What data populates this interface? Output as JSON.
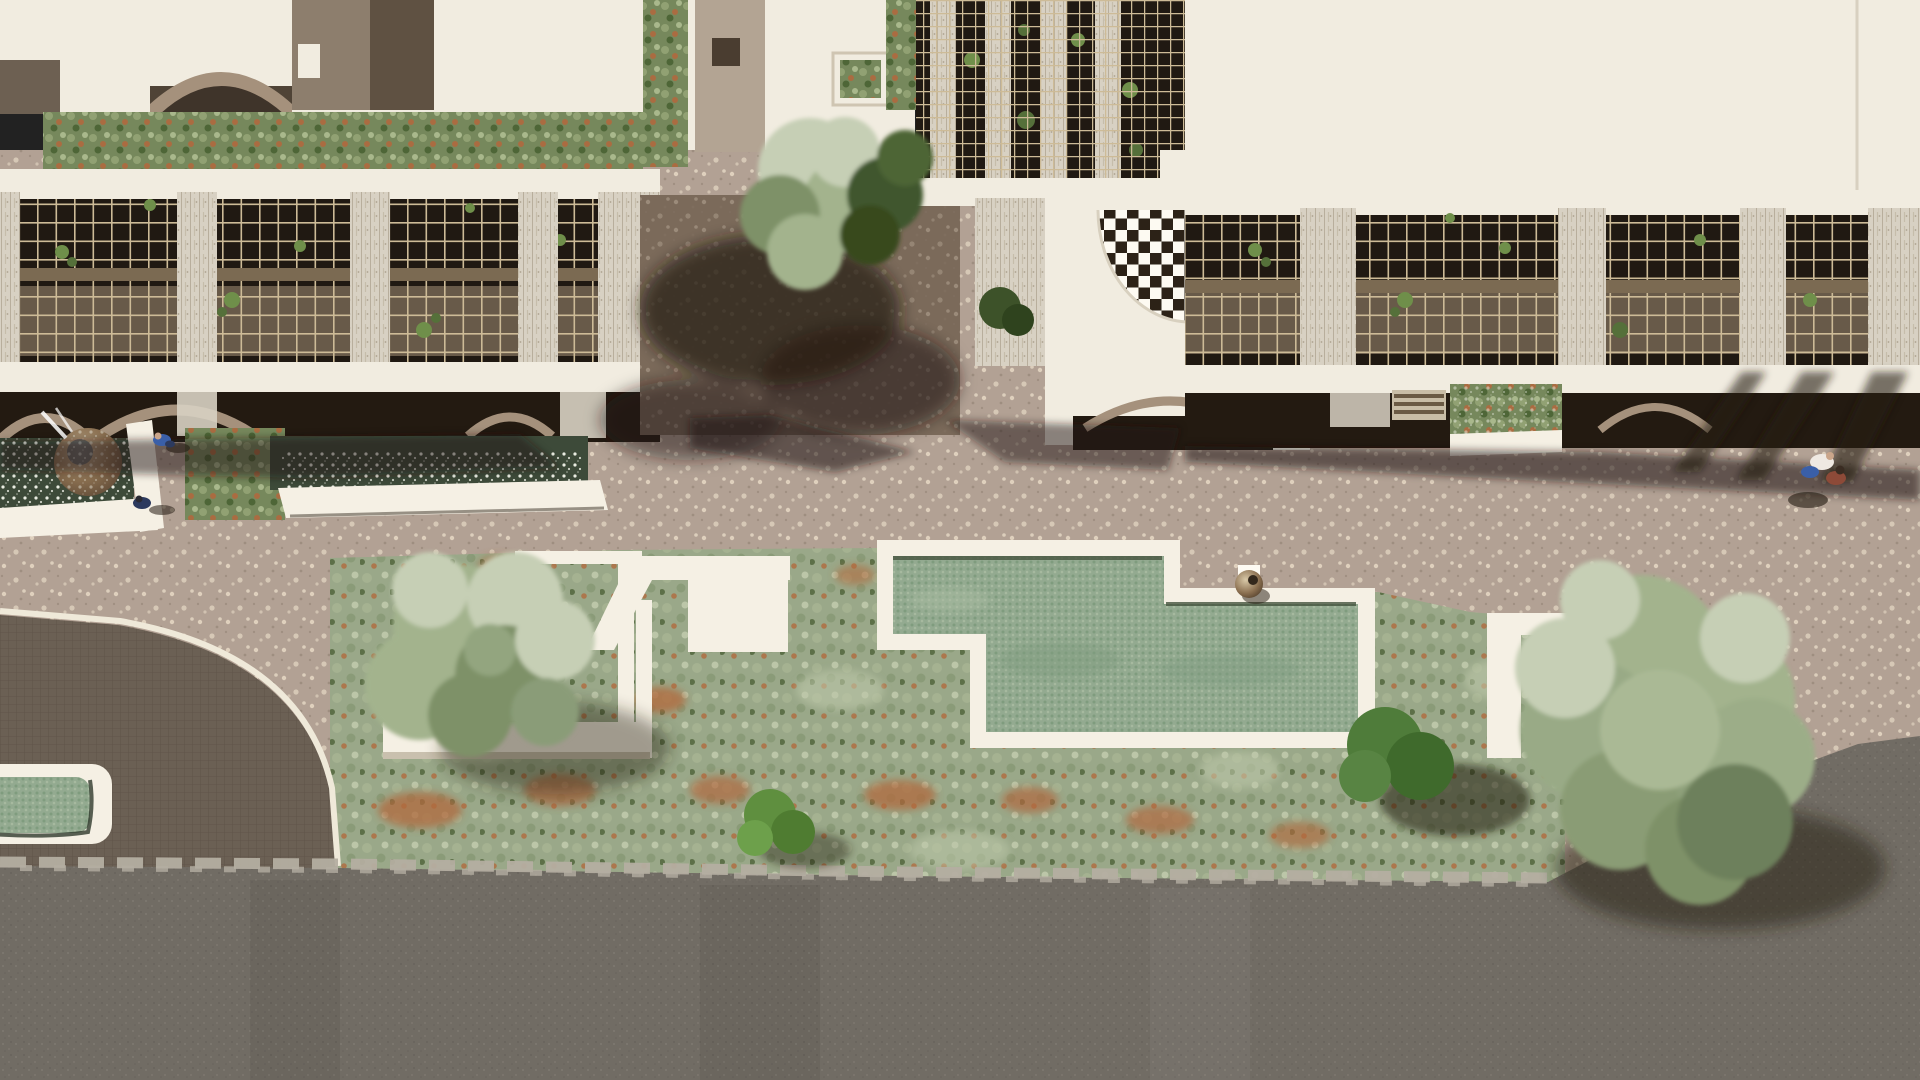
{
  "meta": {
    "title": "Top-down aerial architectural rendering of a residential complex plaza",
    "width": 1920,
    "height": 1080,
    "visible_text": "none"
  },
  "palette": {
    "roof_white": "#f1ece0",
    "roof_white_dim": "#e4dccc",
    "deck_white": "#f5f0e4",
    "ledge_shadow": "#c9c0ae",
    "plaza": "#b2a194",
    "plaza_speckle": "#e6d9c5",
    "plaza_dark_dot": "#8d7d6f",
    "courtyard": "#7b6a5a",
    "taupe_arch": "#a5917c",
    "taupe_dark": "#6d6052",
    "terrace_brown": "#8d7e6d",
    "shadow_dark": "#231a11",
    "trellis_dark": "#201912",
    "trellis_stone": "#80705c",
    "trellis_line": "#cdbb97",
    "rail_brown": "#7b6a52",
    "pier_stone": "#d8d1c3",
    "pier_streak": "#aba08c",
    "screen_hole": "#2c2217",
    "pool_water": "#93aa90",
    "pool_water_dot": "#7e9a7c",
    "pool_water_light": "#a9bba1",
    "pool_edge_dark": "#46543f",
    "reflect_water": "#3d4a39",
    "sparkle_white": "#f2f4ea",
    "garden_sage": "#9aa889",
    "garden_sage_dark": "#839570",
    "garden_sage_light": "#bcc6a8",
    "garden_rust": "#b06a3e",
    "bush_bright": "#5f8f3f",
    "bush_dark": "#44672f",
    "tree_light": "#c6cfb5",
    "tree_mid": "#a3b38d",
    "tree_dark": "#7e9168",
    "driveway": "#6b6054",
    "driveway_line": "#574e42",
    "curb_white": "#efe9d9",
    "road": "#716c64",
    "road_speckle": "#7f7a71",
    "rocky_edge": "#b4aea1",
    "bronze": "#8a6f50",
    "bronze_dark": "#5e4936",
    "person_blue": "#3a5fa8",
    "person_navy": "#2c3a5e",
    "person_white": "#efe9e2",
    "person_red": "#8d4a38"
  },
  "scene": {
    "description": "Bird's-eye rendering: white modern buildings with rooftop planters and tan wire trellis facades along the top; stone piers; a semicircular perforated checkerboard screen; a paved speckled plaza with reflecting pools and a spherical fountain; a central zig-zag green mosaic pool with white deck and a bronze urn; a wide garden strip of sage and rust shrubs with white planter walls and trees; a dark cobbled driveway with curved white curb; a small green pool; an asphalt road along the bottom; four tiny pedestrians.",
    "elements": [
      {
        "name": "left-building",
        "desc": "white roof, planter strip, trellis band with stone piers, arched base, reflecting pools"
      },
      {
        "name": "fountain-sphere",
        "desc": "textured stone sphere fountain in dark sparkling pool, top-left"
      },
      {
        "name": "center-building",
        "desc": "white roofs, rooftop pergola grid, shaded courtyard with two trees"
      },
      {
        "name": "screen-wall",
        "desc": "white wall with semicircular perforated checkerboard screen"
      },
      {
        "name": "right-building",
        "desc": "long trellis facade with piers, arches, hedge planter, cast shadows"
      },
      {
        "name": "zigzag-pool",
        "desc": "Z-shaped green mosaic pool with white deck and bronze urn sculpture"
      },
      {
        "name": "garden-strip",
        "desc": "sage/rust shrub beds, white planter walls, olive trees, bright and dark bushes"
      },
      {
        "name": "driveway",
        "desc": "dark cobbled drive with curved white curb, lower left"
      },
      {
        "name": "small-pool",
        "desc": "small rounded green pool with white border, lower left"
      },
      {
        "name": "road",
        "desc": "gray asphalt band across the bottom with rocky light edge"
      },
      {
        "name": "people",
        "desc": "two walkers near fountain, couple on right plaza"
      }
    ]
  }
}
